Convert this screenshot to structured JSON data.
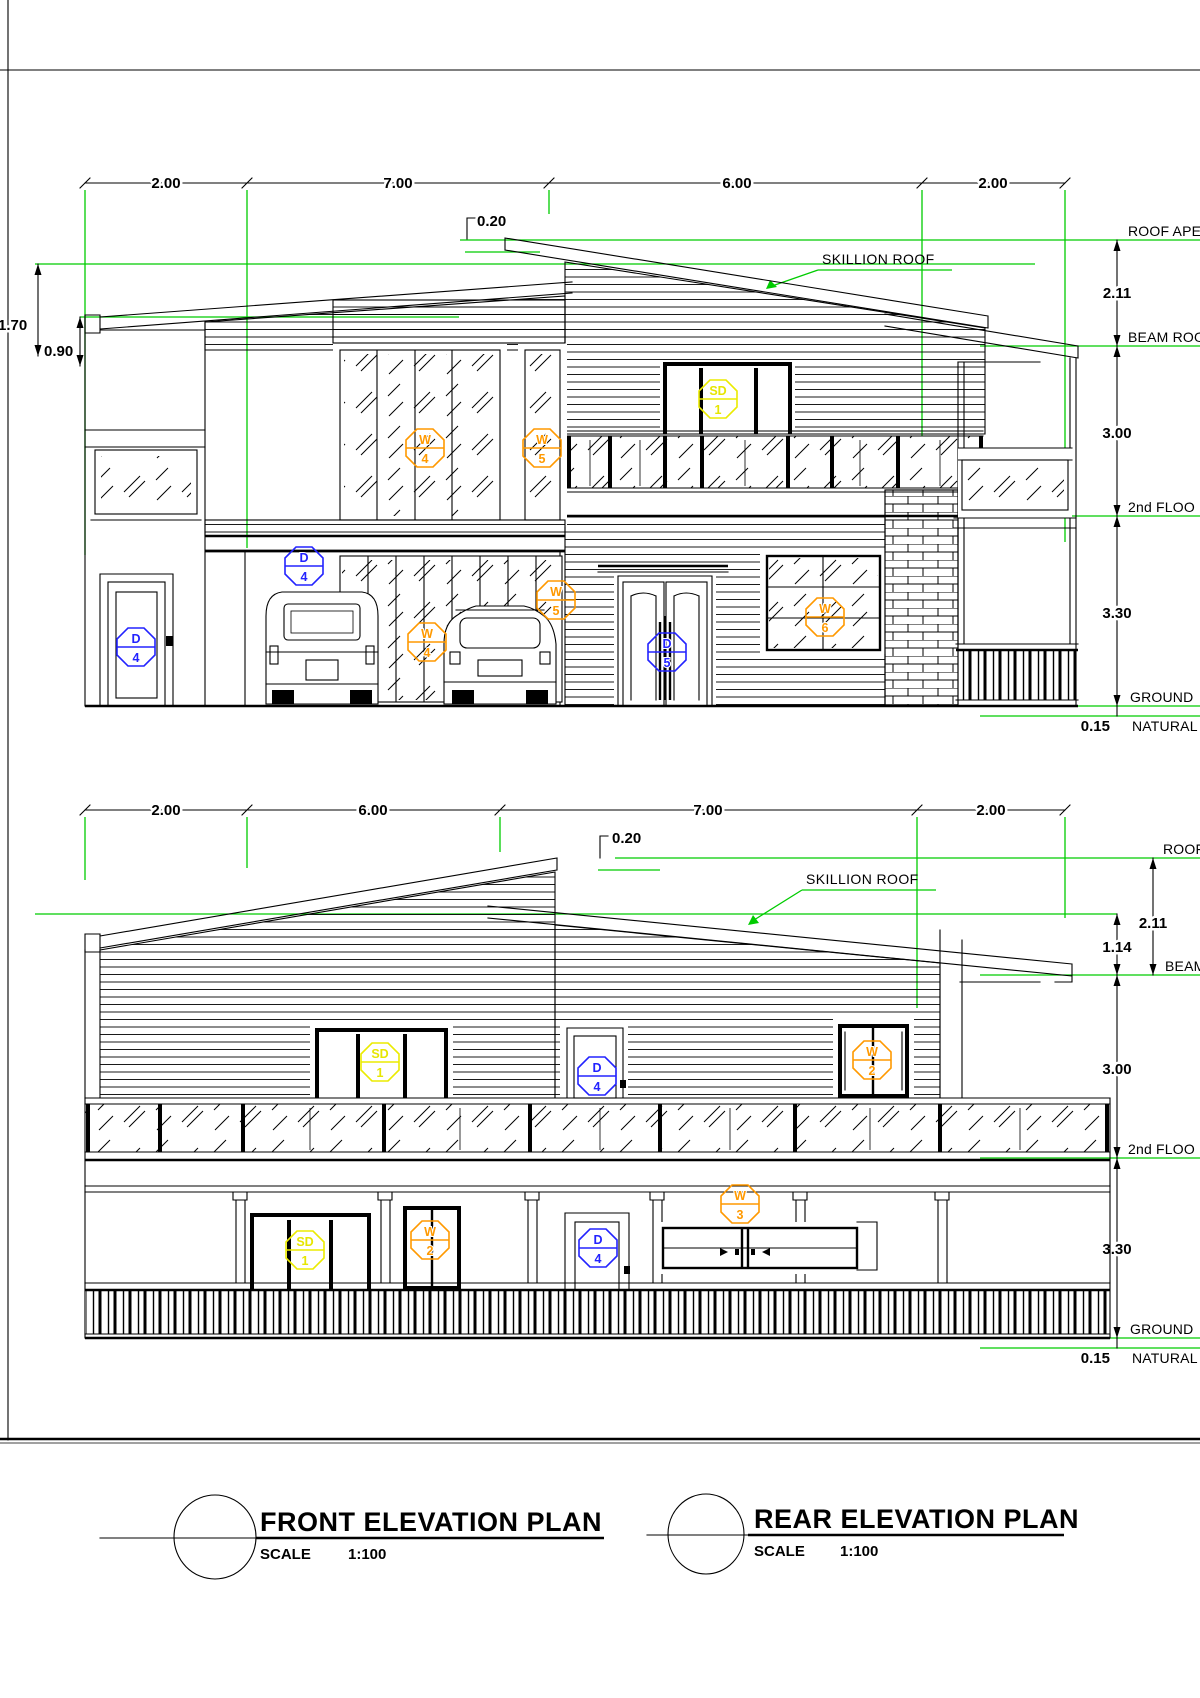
{
  "colors": {
    "line_black": "#000000",
    "dimension_green": "#00cc00",
    "door_tag_blue": "#2323ff",
    "window_tag_orange": "#ff9900",
    "sliding_tag_yellow": "#e6e600"
  },
  "front": {
    "title": "FRONT ELEVATION PLAN",
    "scale_label": "SCALE",
    "scale_value": "1:100",
    "skillion_label": "SKILLION ROOF",
    "dims_top": [
      "2.00",
      "7.00",
      "6.00",
      "2.00"
    ],
    "dim_roof_thickness": "0.20",
    "dim_left_upper": "1.70",
    "dim_left_lower": "0.90",
    "dim_roof_to_beam": "2.11",
    "dim_beam_to_floor": "3.00",
    "dim_floor_to_ground": "3.30",
    "dim_ground_offset": "0.15",
    "levels": {
      "roof_apex": "ROOF APE",
      "beam_roof": "BEAM ROO",
      "second_floor": "2nd FLOO",
      "ground": "GROUND",
      "natural": "NATURAL"
    },
    "tags": [
      {
        "letter": "W",
        "num": "4"
      },
      {
        "letter": "W",
        "num": "5"
      },
      {
        "letter": "D",
        "num": "4"
      },
      {
        "letter": "D",
        "num": "4"
      },
      {
        "letter": "W",
        "num": "4"
      },
      {
        "letter": "W",
        "num": "5"
      },
      {
        "letter": "SD",
        "num": "1"
      },
      {
        "letter": "D",
        "num": "5"
      },
      {
        "letter": "W",
        "num": "6"
      }
    ]
  },
  "rear": {
    "title": "REAR ELEVATION PLAN",
    "scale_label": "SCALE",
    "scale_value": "1:100",
    "skillion_label": "SKILLION ROOF",
    "dims_top": [
      "2.00",
      "6.00",
      "7.00",
      "2.00"
    ],
    "dim_roof_thickness": "0.20",
    "dim_roof_to_beam": "2.11",
    "dim_mid_to_beam": "1.14",
    "dim_beam_to_floor": "3.00",
    "dim_floor_to_ground": "3.30",
    "dim_ground_offset": "0.15",
    "levels": {
      "roof_apex": "ROOF",
      "beam_roof": "BEAM",
      "second_floor": "2nd FLOO",
      "ground": "GROUND",
      "natural": "NATURAL"
    },
    "tags": [
      {
        "letter": "SD",
        "num": "1"
      },
      {
        "letter": "D",
        "num": "4"
      },
      {
        "letter": "W",
        "num": "2"
      },
      {
        "letter": "SD",
        "num": "1"
      },
      {
        "letter": "W",
        "num": "2"
      },
      {
        "letter": "D",
        "num": "4"
      },
      {
        "letter": "W",
        "num": "3"
      }
    ]
  }
}
